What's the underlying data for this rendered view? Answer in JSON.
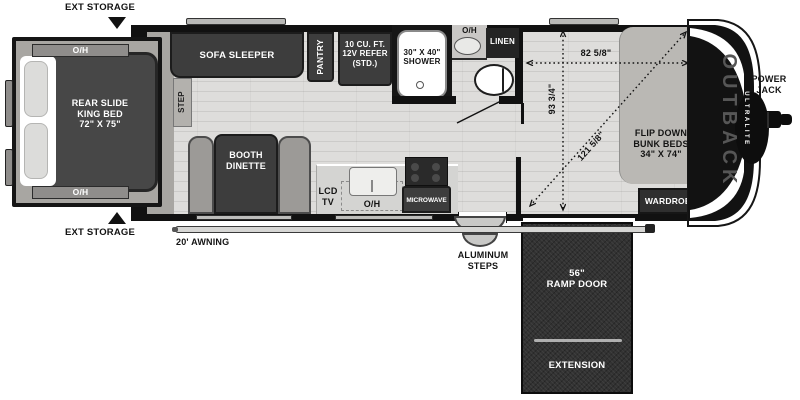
{
  "brand": {
    "name": "OUTBACK",
    "sub": "ULTRALITE"
  },
  "exterior": {
    "ext_storage_top": "EXT STORAGE",
    "ext_storage_bottom": "EXT STORAGE",
    "awning": "20' AWNING",
    "aluminum_steps": "ALUMINUM\nSTEPS",
    "power_jack": "POWER\nJACK"
  },
  "bedroom": {
    "bed": "REAR SLIDE\nKING BED\n72\" X 75\"",
    "oh_top": "O/H",
    "oh_bottom": "O/H",
    "step": "STEP"
  },
  "living": {
    "sofa": "SOFA SLEEPER",
    "dinette": "BOOTH\nDINETTE",
    "lcd_tv": "LCD\nTV"
  },
  "kitchen": {
    "pantry": "PANTRY",
    "refer": "10 CU. FT.\n12V REFER\n(STD.)",
    "oh": "O/H",
    "microwave": "MICROWAVE"
  },
  "bathroom": {
    "shower": "30\" X 40\"\nSHOWER",
    "oh": "O/H",
    "linen": "LINEN"
  },
  "garage": {
    "bunks": "FLIP DOWN\nBUNK BEDS\n34\" X 74\"",
    "wardrobe": "WARDROBE",
    "ramp_door": "56\"\nRAMP DOOR",
    "extension": "EXTENSION"
  },
  "dimensions": {
    "width": "82 5/8\"",
    "height": "93 3/4\"",
    "diagonal": "121 5/8\""
  },
  "colors": {
    "wall": "#111111",
    "furniture_dark": "#3d3d3d",
    "floor": "#dcdcda",
    "slide_trim": "#a8a6a2",
    "panel_gray": "#bab8b4",
    "ramp_dark": "#323232",
    "white": "#ffffff"
  }
}
